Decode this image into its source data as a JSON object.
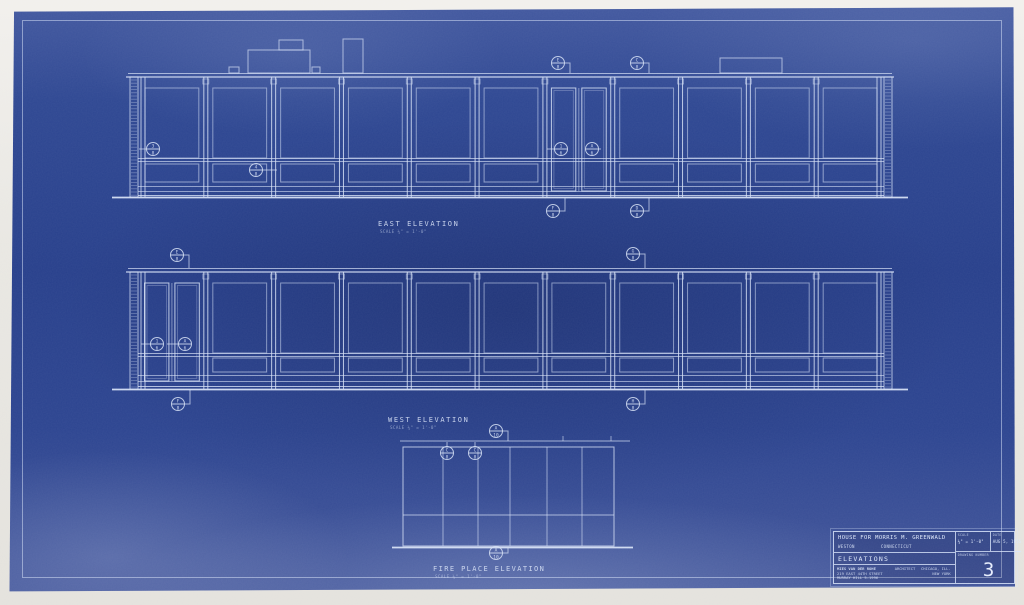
{
  "labels": {
    "east": {
      "title": "EAST  ELEVATION",
      "scale": "SCALE  ¼\" = 1'-0\""
    },
    "west": {
      "title": "WEST  ELEVATION",
      "scale": "SCALE  ¼\" = 1'-0\""
    },
    "fireplace": {
      "title": "FIRE  PLACE  ELEVATION",
      "scale": "SCALE  ¼\" = 1'-0\""
    }
  },
  "title_block": {
    "project": "HOUSE  FOR  MORRIS  M. GREENWALD",
    "town": "WESTON",
    "state": "CONNECTICUT",
    "sheet_title": "ELEVATIONS",
    "architect_name": "MIES VAN DER ROHE",
    "architect_address": "219 EAST 44TH STREET",
    "architect_phone": "MURRAY HILL 5-1996",
    "architect_role": "ARCHITECT",
    "architect_city1": "CHICAGO, ILL.",
    "architect_city2": "NEW YORK",
    "scale_label": "SCALE",
    "scale_value": "¼\" = 1'-0\"",
    "date_label": "DATE",
    "date_value": "AUG 5, 1955",
    "number_label": "DRAWING NUMBER",
    "number": "3"
  },
  "colors": {
    "paper": "#e9e7e2",
    "blueprint_blue": "#273f8b",
    "line": "#d6e0f5"
  },
  "drawing": {
    "line_color": "#d6e0f5",
    "elevations": [
      {
        "id": "east",
        "x0": 138,
        "x1": 884,
        "roof": 73,
        "glass_top": 88,
        "transom": 158,
        "spandrel_top": 164,
        "spandrel_bot": 182,
        "rail": 186,
        "base": 191,
        "base2": 195,
        "ground": 197,
        "bays": 11,
        "door_bay": 6,
        "roof_boxes": [
          [
            229,
            67,
            10,
            6
          ],
          [
            248,
            50,
            62,
            23
          ],
          [
            279,
            40,
            24,
            10
          ],
          [
            312,
            67,
            8,
            6
          ],
          [
            343,
            39,
            20,
            34
          ],
          [
            720,
            58,
            62,
            15
          ]
        ],
        "markers": [
          {
            "x": 153,
            "y": 149,
            "t": "3",
            "b": "8",
            "ld": 139
          },
          {
            "x": 256,
            "y": 170,
            "t": "4",
            "b": "8",
            "rd": 277
          },
          {
            "x": 561,
            "y": 149,
            "t": "1",
            "b": "6",
            "ld": 547
          },
          {
            "x": 592,
            "y": 149,
            "t": "A",
            "b": "6",
            "rd": 601
          },
          {
            "x": 558,
            "y": 63,
            "t": "E",
            "b": "8",
            "br": 73
          },
          {
            "x": 637,
            "y": 63,
            "t": "C",
            "b": "8",
            "br": 73
          },
          {
            "x": 553,
            "y": 211,
            "t": "F",
            "b": "8",
            "br": 198
          },
          {
            "x": 637,
            "y": 211,
            "t": "D",
            "b": "8",
            "br": 198
          }
        ],
        "label_xy": [
          378,
          226
        ]
      },
      {
        "id": "west",
        "x0": 138,
        "x1": 884,
        "roof": 268,
        "glass_top": 283,
        "transom": 353,
        "spandrel_top": 358,
        "spandrel_bot": 372,
        "rail": 375,
        "base": 381,
        "base2": 386,
        "ground": 389,
        "bays": 11,
        "door_bay": 0,
        "roof_boxes": [],
        "markers": [
          {
            "x": 157,
            "y": 344,
            "t": "1",
            "b": "6",
            "ld": 141
          },
          {
            "x": 185,
            "y": 344,
            "t": "A",
            "b": "6",
            "ld": 167
          },
          {
            "x": 177,
            "y": 255,
            "t": "E",
            "b": "8",
            "br": 268
          },
          {
            "x": 633,
            "y": 254,
            "t": "G",
            "b": "8",
            "br": 268
          },
          {
            "x": 178,
            "y": 404,
            "t": "F",
            "b": "8",
            "br": 390
          },
          {
            "x": 633,
            "y": 404,
            "t": "H",
            "b": "8",
            "br": 390
          }
        ],
        "label_xy": [
          388,
          422
        ]
      }
    ],
    "fireplace": {
      "x0": 403,
      "x1": 614,
      "top": 447,
      "bottom": 546,
      "ceil": 441,
      "ceil_x0": 400,
      "ceil_x1": 630,
      "ceil_ticks": [
        563,
        611
      ],
      "verticals": [
        443,
        478,
        510,
        547,
        582
      ],
      "bench": 515,
      "ground_x0": 392,
      "ground_x1": 633,
      "markers": [
        {
          "x": 447,
          "y": 453,
          "t": "C",
          "b": "8",
          "vb": 442
        },
        {
          "x": 475,
          "y": 453,
          "t": "C",
          "b": "8",
          "vb": 442
        },
        {
          "x": 496,
          "y": 431,
          "t": "A",
          "b": "10",
          "br": 441
        },
        {
          "x": 496,
          "y": 553,
          "t": "A",
          "b": "10",
          "br": 548
        }
      ],
      "label_xy": [
        433,
        571
      ]
    }
  }
}
